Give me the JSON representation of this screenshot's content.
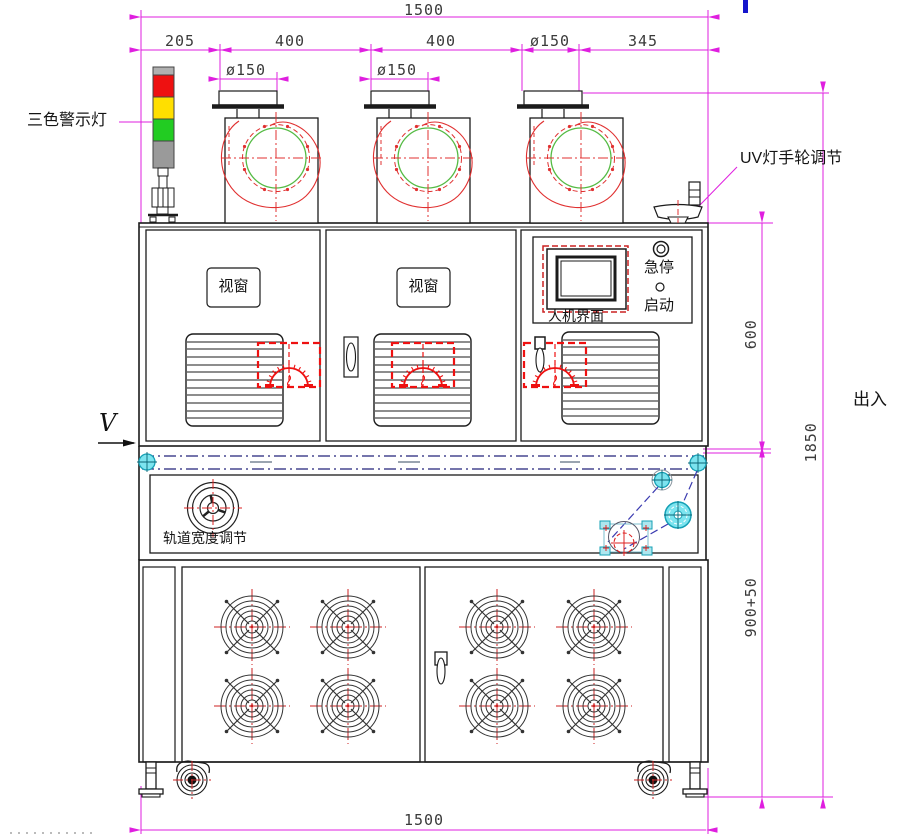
{
  "drawing": {
    "title": "UV固化机正视图",
    "dims": {
      "top_total": "1500",
      "chain": [
        "205",
        "400",
        "400",
        "ø150",
        "345"
      ],
      "blower1_flange": "ø150",
      "blower2_flange": "ø150",
      "upper_height": "600",
      "lower_height": "900+50",
      "total_height": "1850",
      "bottom_total": "1500"
    },
    "labels": {
      "tricolor_light": "三色警示灯",
      "uv_handwheel": "UV灯手轮调节",
      "window_1": "视窗",
      "window_2": "视窗",
      "hmi": "人机界面",
      "emergency_stop": "急停",
      "start": "启动",
      "track_width": "轨道宽度调节",
      "in_out": "出入",
      "view_arrow": "V"
    },
    "colors": {
      "dimension_magenta": "#df1fdf",
      "line_black": "#1b1b1b",
      "line_red": "#e03030",
      "line_green": "#55bb44",
      "part_cyan": "#7ce4ef",
      "belt_navy": "#23237a",
      "lamp_red": "#ee1111",
      "lamp_yellow": "#ffdf00",
      "lamp_green": "#22cc22",
      "artifact_blue": "#1515cc"
    }
  }
}
